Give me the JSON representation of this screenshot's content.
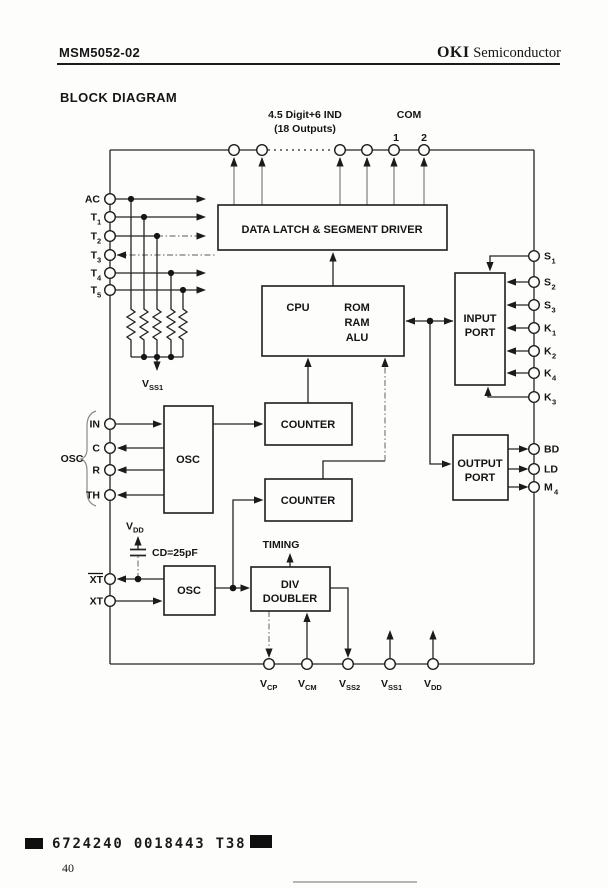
{
  "header": {
    "part_number": "MSM5052-02",
    "brand_bold": "OKI",
    "brand_rest": "Semiconductor"
  },
  "section_title": "BLOCK DIAGRAM",
  "diagram": {
    "top": {
      "digits_line1": "4.5 Digit+6 IND",
      "digits_line2": "(18 Outputs)",
      "com": "COM",
      "com_1": "1",
      "com_2": "2"
    },
    "blocks": {
      "data_latch": "DATA LATCH & SEGMENT DRIVER",
      "cpu": "CPU",
      "rom": "ROM",
      "ram": "RAM",
      "alu": "ALU",
      "input_port_line1": "INPUT",
      "input_port_line2": "PORT",
      "output_port_line1": "OUTPUT",
      "output_port_line2": "PORT",
      "counter_top": "COUNTER",
      "counter_bottom": "COUNTER",
      "osc_top": "OSC",
      "osc_bottom": "OSC",
      "div_line1": "DIV",
      "div_line2": "DOUBLER"
    },
    "annotations": {
      "osc_group": "OSC",
      "timing": "TIMING",
      "cap_value": "CD=25pF",
      "vdd_base": "V",
      "vdd_sub": "DD",
      "vss1_base": "V",
      "vss1_sub": "SS1"
    },
    "pins": {
      "left": [
        {
          "base": "AC",
          "sub": ""
        },
        {
          "base": "T",
          "sub": "1"
        },
        {
          "base": "T",
          "sub": "2"
        },
        {
          "base": "T",
          "sub": "3"
        },
        {
          "base": "T",
          "sub": "4"
        },
        {
          "base": "T",
          "sub": "5"
        },
        {
          "base": "IN",
          "sub": ""
        },
        {
          "base": "C",
          "sub": ""
        },
        {
          "base": "R",
          "sub": ""
        },
        {
          "base": "TH",
          "sub": ""
        },
        {
          "base": "XT",
          "sub": "",
          "overline": true
        },
        {
          "base": "XT",
          "sub": ""
        }
      ],
      "right": [
        {
          "base": "S",
          "sub": "1"
        },
        {
          "base": "S",
          "sub": "2"
        },
        {
          "base": "S",
          "sub": "3"
        },
        {
          "base": "K",
          "sub": "1"
        },
        {
          "base": "K",
          "sub": "2"
        },
        {
          "base": "K",
          "sub": "4"
        },
        {
          "base": "K",
          "sub": "3"
        },
        {
          "base": "BD",
          "sub": ""
        },
        {
          "base": "LD",
          "sub": ""
        },
        {
          "base": "M",
          "sub": "4"
        }
      ],
      "bottom": [
        {
          "base": "V",
          "sub": "CP"
        },
        {
          "base": "V",
          "sub": "CM"
        },
        {
          "base": "V",
          "sub": "SS2"
        },
        {
          "base": "V",
          "sub": "SS1"
        },
        {
          "base": "V",
          "sub": "DD"
        }
      ]
    }
  },
  "footer": {
    "code": "6724240 0018443 T38",
    "page_number": "40"
  }
}
